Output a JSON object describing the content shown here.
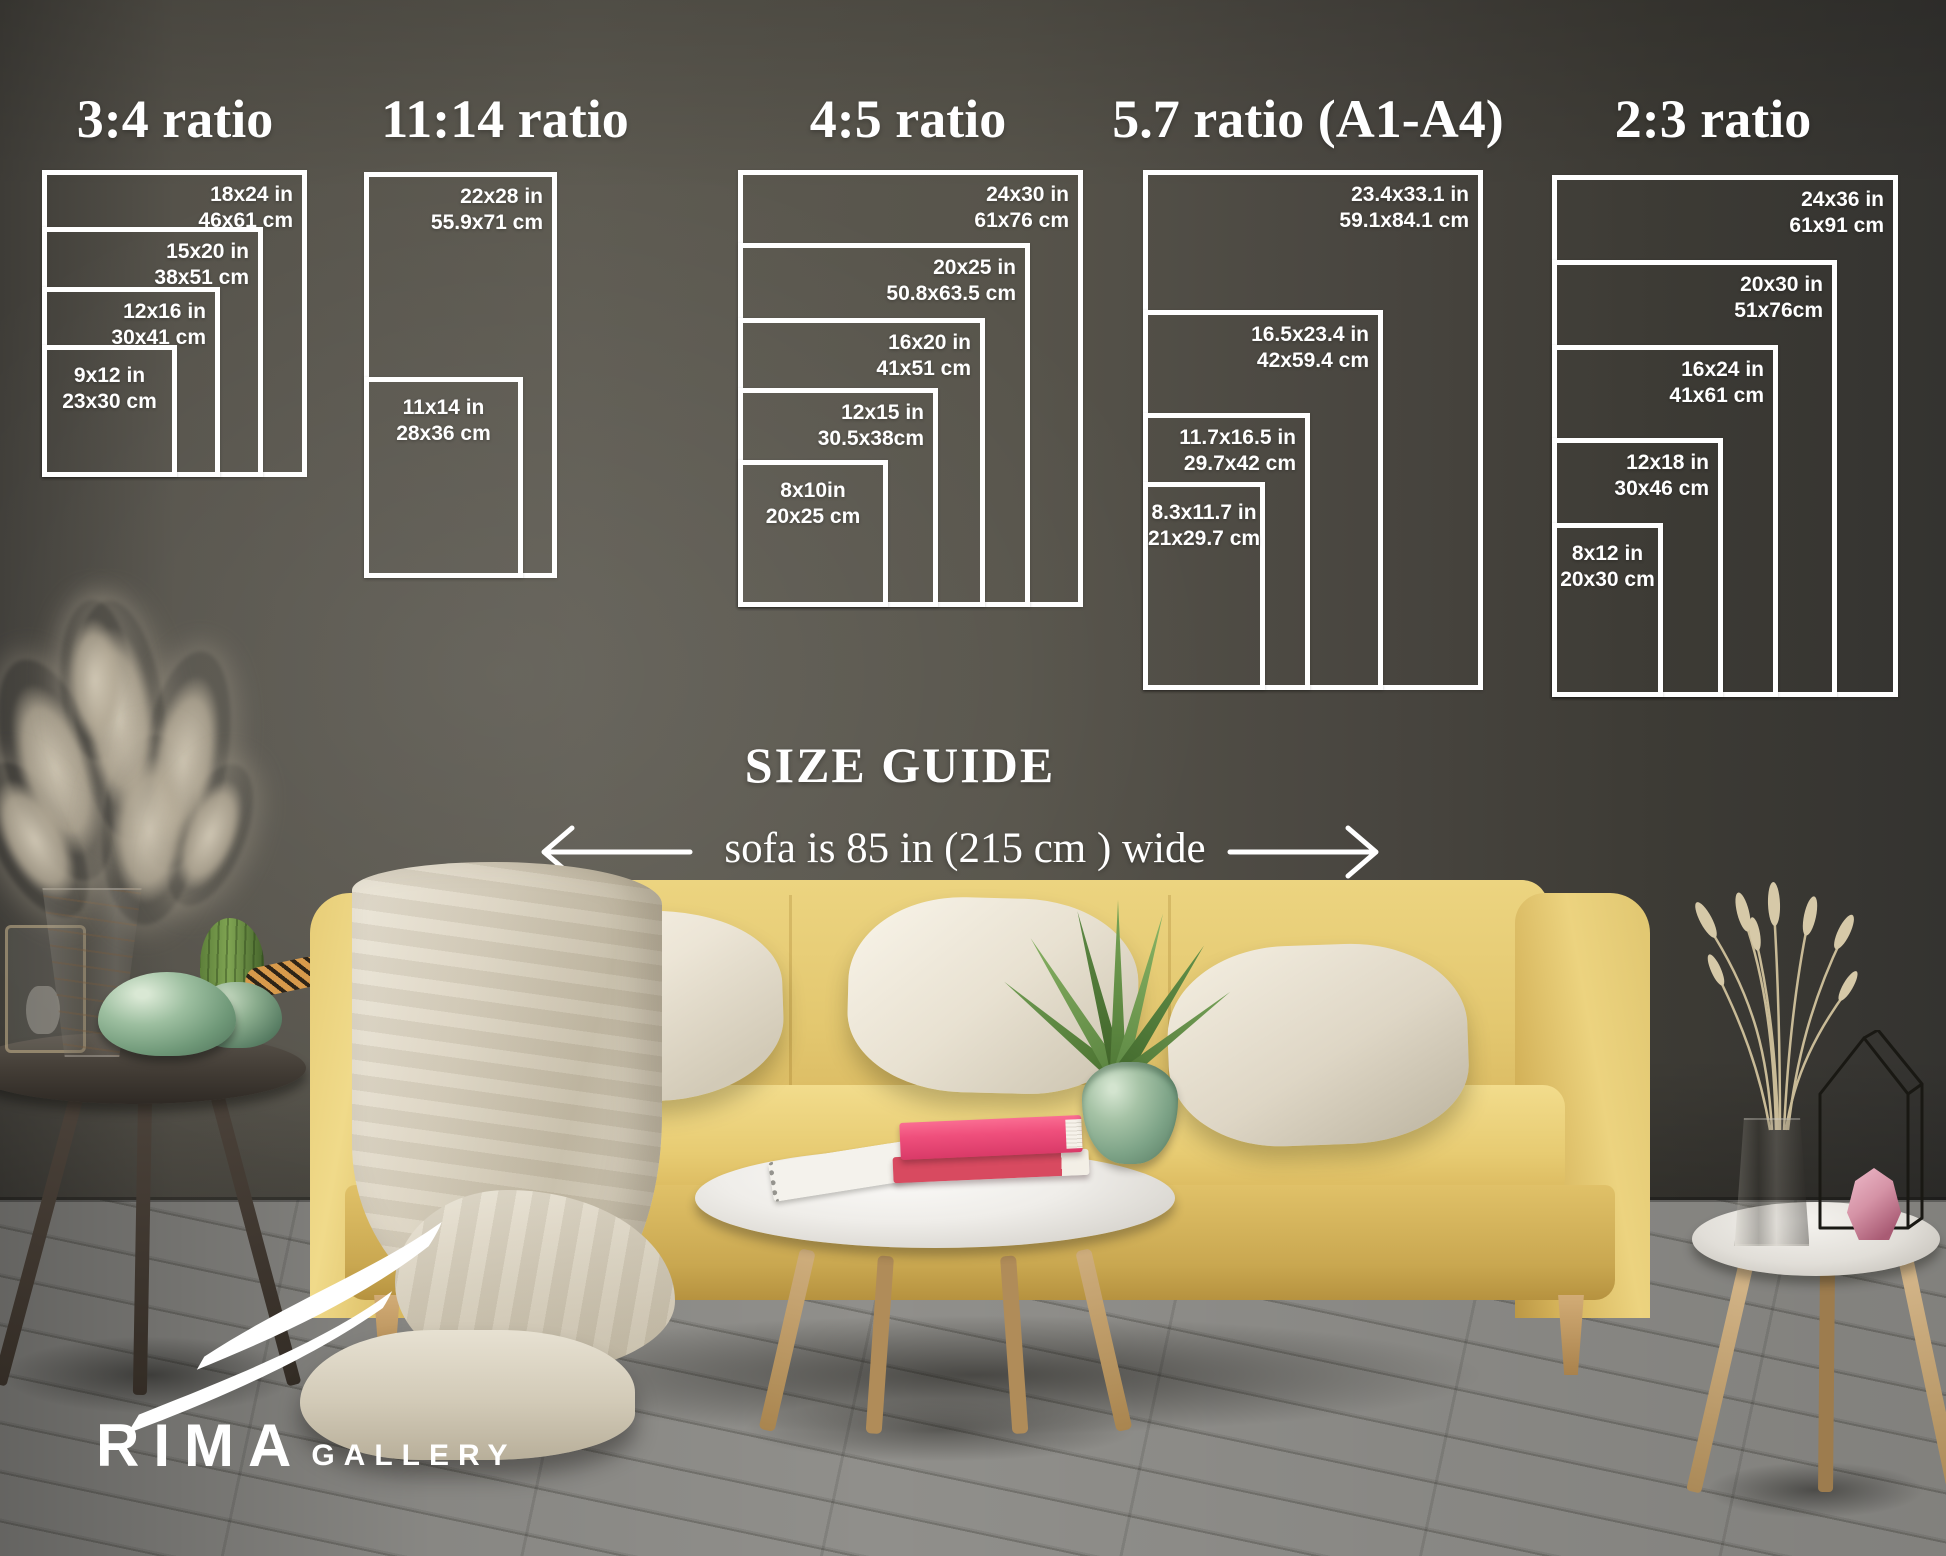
{
  "size_guide": {
    "heading": "SIZE GUIDE",
    "sofa_note": "sofa is 85 in (215 cm ) wide",
    "text_color": "#ffffff",
    "groups": [
      {
        "title": "3:4 ratio",
        "title_cx": 175,
        "frames": [
          {
            "size_in": "18x24 in",
            "size_cm": "46x61 cm",
            "rect": [
              42,
              170,
              265,
              307
            ],
            "label_pos": "top-right"
          },
          {
            "size_in": "15x20 in",
            "size_cm": "38x51 cm",
            "rect": [
              42,
              227,
              221,
              250
            ],
            "label_pos": "top-right"
          },
          {
            "size_in": "12x16 in",
            "size_cm": "30x41 cm",
            "rect": [
              42,
              287,
              178,
              190
            ],
            "label_pos": "top-right"
          },
          {
            "size_in": "9x12 in",
            "size_cm": "23x30 cm",
            "rect": [
              42,
              345,
              135,
              132
            ],
            "label_pos": "top-center"
          }
        ]
      },
      {
        "title": "11:14 ratio",
        "title_cx": 505,
        "frames": [
          {
            "size_in": "22x28 in",
            "size_cm": "55.9x71 cm",
            "rect": [
              364,
              172,
              193,
              406
            ],
            "label_pos": "top-right"
          },
          {
            "size_in": "11x14 in",
            "size_cm": "28x36 cm",
            "rect": [
              364,
              377,
              159,
              201
            ],
            "label_pos": "top-center"
          }
        ]
      },
      {
        "title": "4:5 ratio",
        "title_cx": 908,
        "frames": [
          {
            "size_in": "24x30 in",
            "size_cm": "61x76 cm",
            "rect": [
              738,
              170,
              345,
              437
            ],
            "label_pos": "top-right"
          },
          {
            "size_in": "20x25 in",
            "size_cm": "50.8x63.5 cm",
            "rect": [
              738,
              243,
              292,
              364
            ],
            "label_pos": "top-right"
          },
          {
            "size_in": "16x20 in",
            "size_cm": "41x51 cm",
            "rect": [
              738,
              318,
              247,
              289
            ],
            "label_pos": "top-right"
          },
          {
            "size_in": "12x15 in",
            "size_cm": "30.5x38cm",
            "rect": [
              738,
              388,
              200,
              219
            ],
            "label_pos": "top-right"
          },
          {
            "size_in": "8x10in",
            "size_cm": "20x25 cm",
            "rect": [
              738,
              460,
              150,
              147
            ],
            "label_pos": "top-center"
          }
        ]
      },
      {
        "title": "5.7 ratio (A1-A4)",
        "title_cx": 1308,
        "frames": [
          {
            "size_in": "23.4x33.1 in",
            "size_cm": "59.1x84.1 cm",
            "rect": [
              1143,
              170,
              340,
              520
            ],
            "label_pos": "top-right"
          },
          {
            "size_in": "16.5x23.4 in",
            "size_cm": "42x59.4 cm",
            "rect": [
              1143,
              310,
              240,
              380
            ],
            "label_pos": "top-right"
          },
          {
            "size_in": "11.7x16.5 in",
            "size_cm": "29.7x42 cm",
            "rect": [
              1143,
              413,
              167,
              277
            ],
            "label_pos": "top-right"
          },
          {
            "size_in": "8.3x11.7 in",
            "size_cm": "21x29.7 cm",
            "rect": [
              1143,
              482,
              122,
              208
            ],
            "label_pos": "top-center"
          }
        ]
      },
      {
        "title": "2:3 ratio",
        "title_cx": 1713,
        "frames": [
          {
            "size_in": "24x36 in",
            "size_cm": "61x91 cm",
            "rect": [
              1552,
              175,
              346,
              522
            ],
            "label_pos": "top-right"
          },
          {
            "size_in": "20x30 in",
            "size_cm": "51x76cm",
            "rect": [
              1552,
              260,
              285,
              437
            ],
            "label_pos": "top-right"
          },
          {
            "size_in": "16x24 in",
            "size_cm": "41x61 cm",
            "rect": [
              1552,
              345,
              226,
              352
            ],
            "label_pos": "top-right"
          },
          {
            "size_in": "12x18 in",
            "size_cm": "30x46 cm",
            "rect": [
              1552,
              438,
              171,
              259
            ],
            "label_pos": "top-right"
          },
          {
            "size_in": "8x12 in",
            "size_cm": "20x30 cm",
            "rect": [
              1552,
              523,
              111,
              174
            ],
            "label_pos": "top-center"
          }
        ]
      }
    ]
  },
  "logo": {
    "brand": "RIMA",
    "suffix": "GALLERY",
    "icon": "rima-swoosh-icon"
  },
  "icons": {
    "sofa_width_arrows": [
      "long-arrow-left-icon",
      "long-arrow-right-icon"
    ]
  },
  "colors": {
    "guide_white": "#ffffff",
    "wall_gray": "#55524a",
    "floor_gray": "#8a8985",
    "sofa_yellow": "#e3c76f",
    "pillow_cream": "#efe9db",
    "book_pink": "#ee4d7b",
    "plant_green": "#79a657",
    "vase_jade": "#9dbfa0"
  }
}
